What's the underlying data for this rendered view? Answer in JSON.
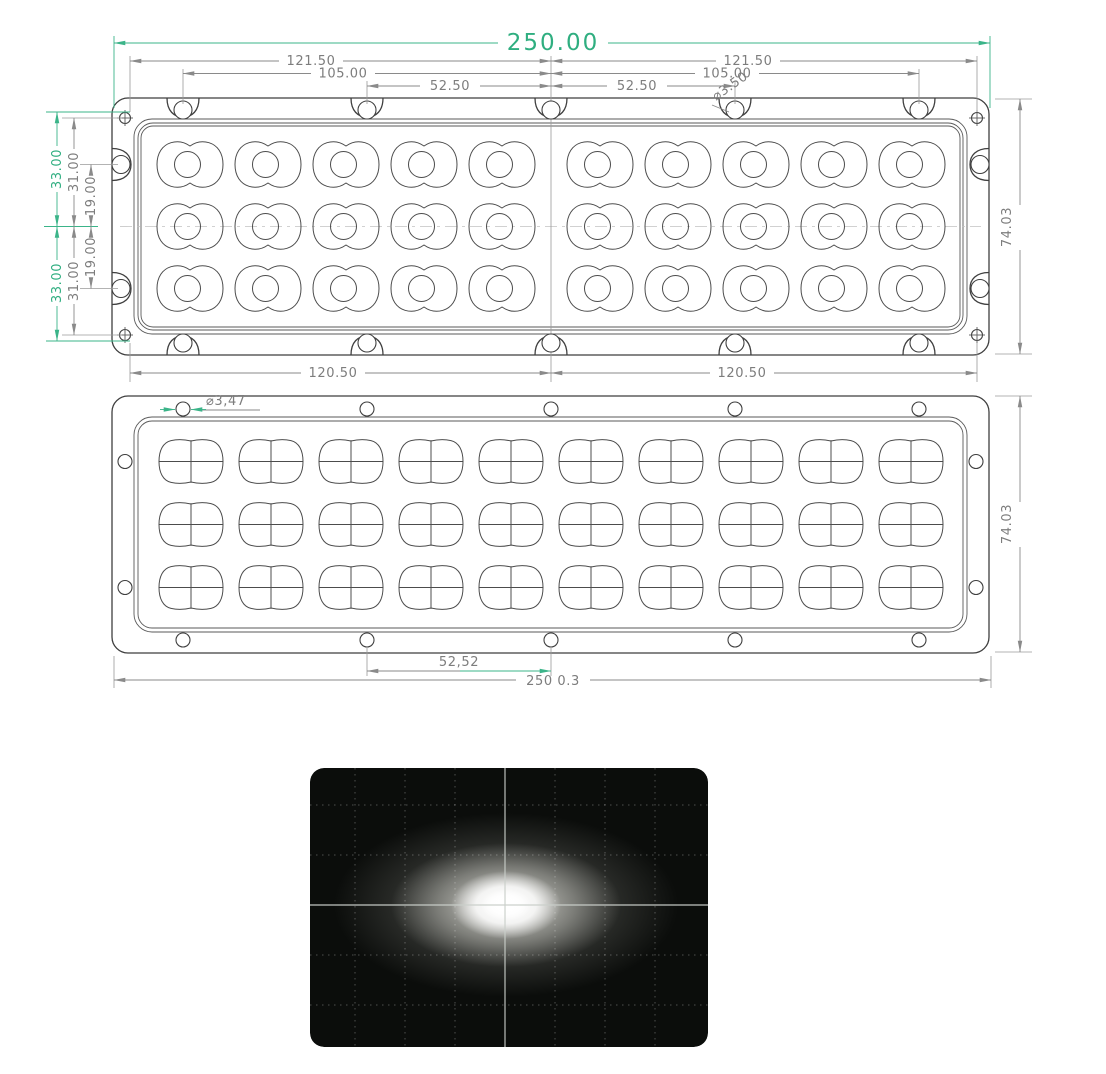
{
  "colors": {
    "accent_green": "#2fae80",
    "accent_green_line": "#3bb489",
    "drawing_line": "#3f3f3f",
    "dimension_gray": "#7d7d7d"
  },
  "top_view": {
    "overall_width": "250.00",
    "span_left": "121.50",
    "span_right": "121.50",
    "pitch_left": "105.00",
    "pitch_right": "105.00",
    "half_left": "52.50",
    "half_right": "52.50",
    "hole_diameter": "⌀3.50",
    "edge_top": "33.00",
    "edge_bottom": "33.00",
    "corner_top": "31.00",
    "corner_bottom": "31.00",
    "row_top": "19.00",
    "row_bottom": "19.00",
    "base_left": "120.50",
    "base_right": "120.50",
    "overall_height": "74.03"
  },
  "bottom_view": {
    "hole_diameter": "⌀3,47",
    "hole_pitch": "52,52",
    "overall_width": "250 0.3",
    "overall_height": "74.03"
  },
  "photometric": {
    "background": "#0b0d0b",
    "grid": "#c9cec9",
    "glow": "#ffffff"
  }
}
